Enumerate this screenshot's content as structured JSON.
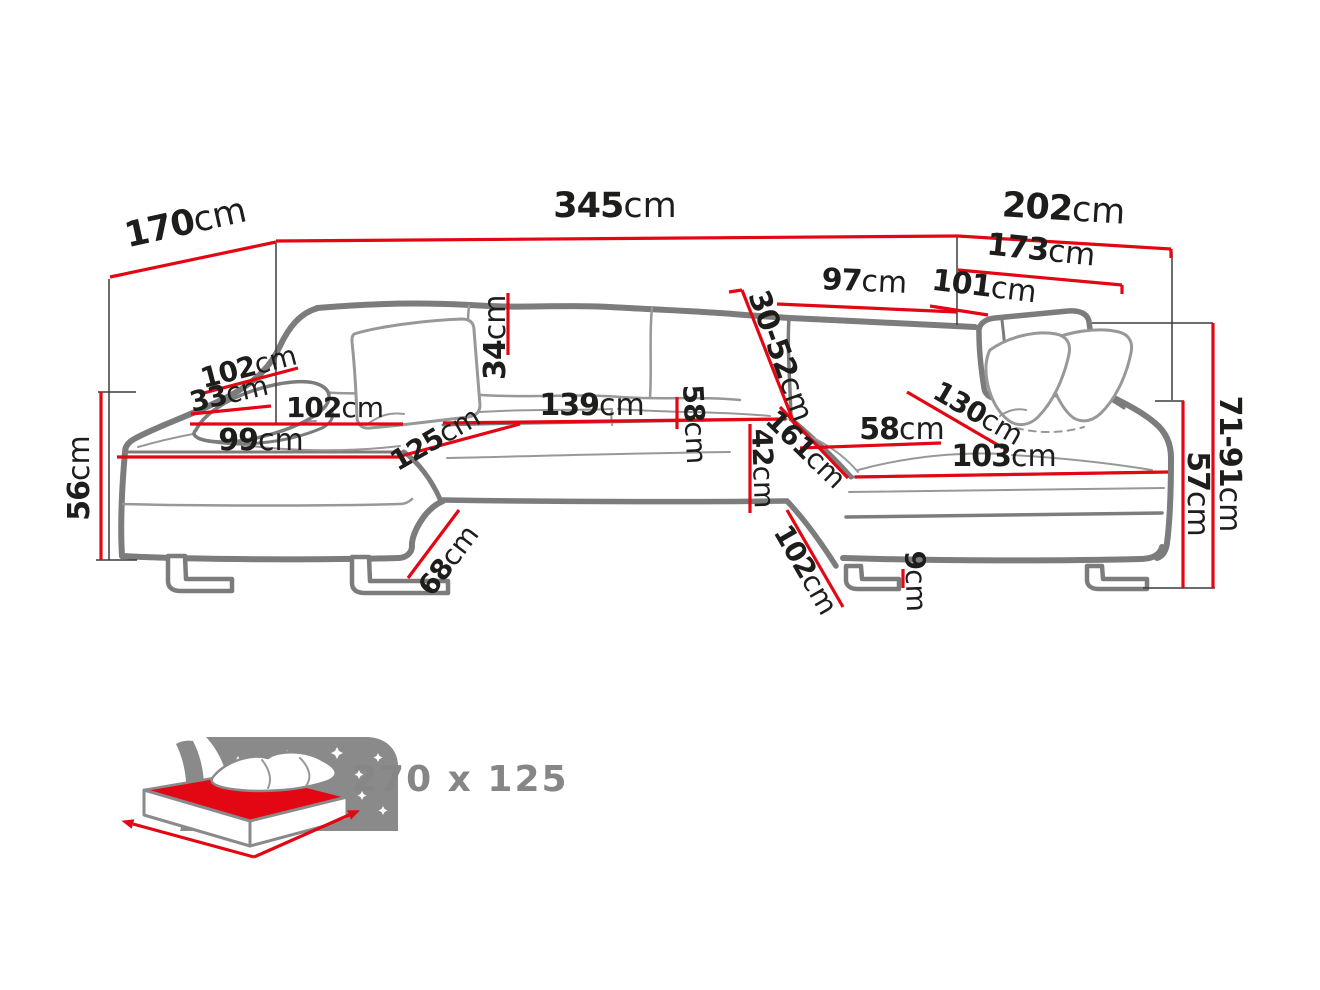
{
  "diagram": {
    "type": "corner-sofa-dimension-diagram",
    "colors": {
      "dimension_line": "#e30613",
      "sofa_outline": "#7c7c7c",
      "label_text": "#1d1d1b",
      "muted_text": "#868686"
    },
    "dims": {
      "d170": {
        "value": "170",
        "unit": "cm"
      },
      "d345": {
        "value": "345",
        "unit": "cm"
      },
      "d202": {
        "value": "202",
        "unit": "cm"
      },
      "d173": {
        "value": "173",
        "unit": "cm"
      },
      "d97": {
        "value": "97",
        "unit": "cm"
      },
      "d101": {
        "value": "101",
        "unit": "cm"
      },
      "d30_52": {
        "value": "30-52",
        "unit": "cm"
      },
      "d34": {
        "value": "34",
        "unit": "cm"
      },
      "d102a": {
        "value": "102",
        "unit": "cm"
      },
      "d33": {
        "value": "33",
        "unit": "cm"
      },
      "d102b": {
        "value": "102",
        "unit": "cm"
      },
      "d99": {
        "value": "99",
        "unit": "cm"
      },
      "d125": {
        "value": "125",
        "unit": "cm"
      },
      "d139": {
        "value": "139",
        "unit": "cm"
      },
      "d58a": {
        "value": "58",
        "unit": "cm"
      },
      "d42": {
        "value": "42",
        "unit": "cm"
      },
      "d161": {
        "value": "161",
        "unit": "cm"
      },
      "d58b": {
        "value": "58",
        "unit": "cm"
      },
      "d130": {
        "value": "130",
        "unit": "cm"
      },
      "d103": {
        "value": "103",
        "unit": "cm"
      },
      "d68": {
        "value": "68",
        "unit": "cm"
      },
      "d102c": {
        "value": "102",
        "unit": "cm"
      },
      "d9": {
        "value": "9",
        "unit": "cm"
      },
      "d56": {
        "value": "56",
        "unit": "cm"
      },
      "d71_91": {
        "value": "71-91",
        "unit": "cm"
      },
      "d57": {
        "value": "57",
        "unit": "cm"
      }
    },
    "sleeping_function": {
      "size_label": "270 x 125",
      "icon": "sleeping-bed-icon"
    }
  }
}
